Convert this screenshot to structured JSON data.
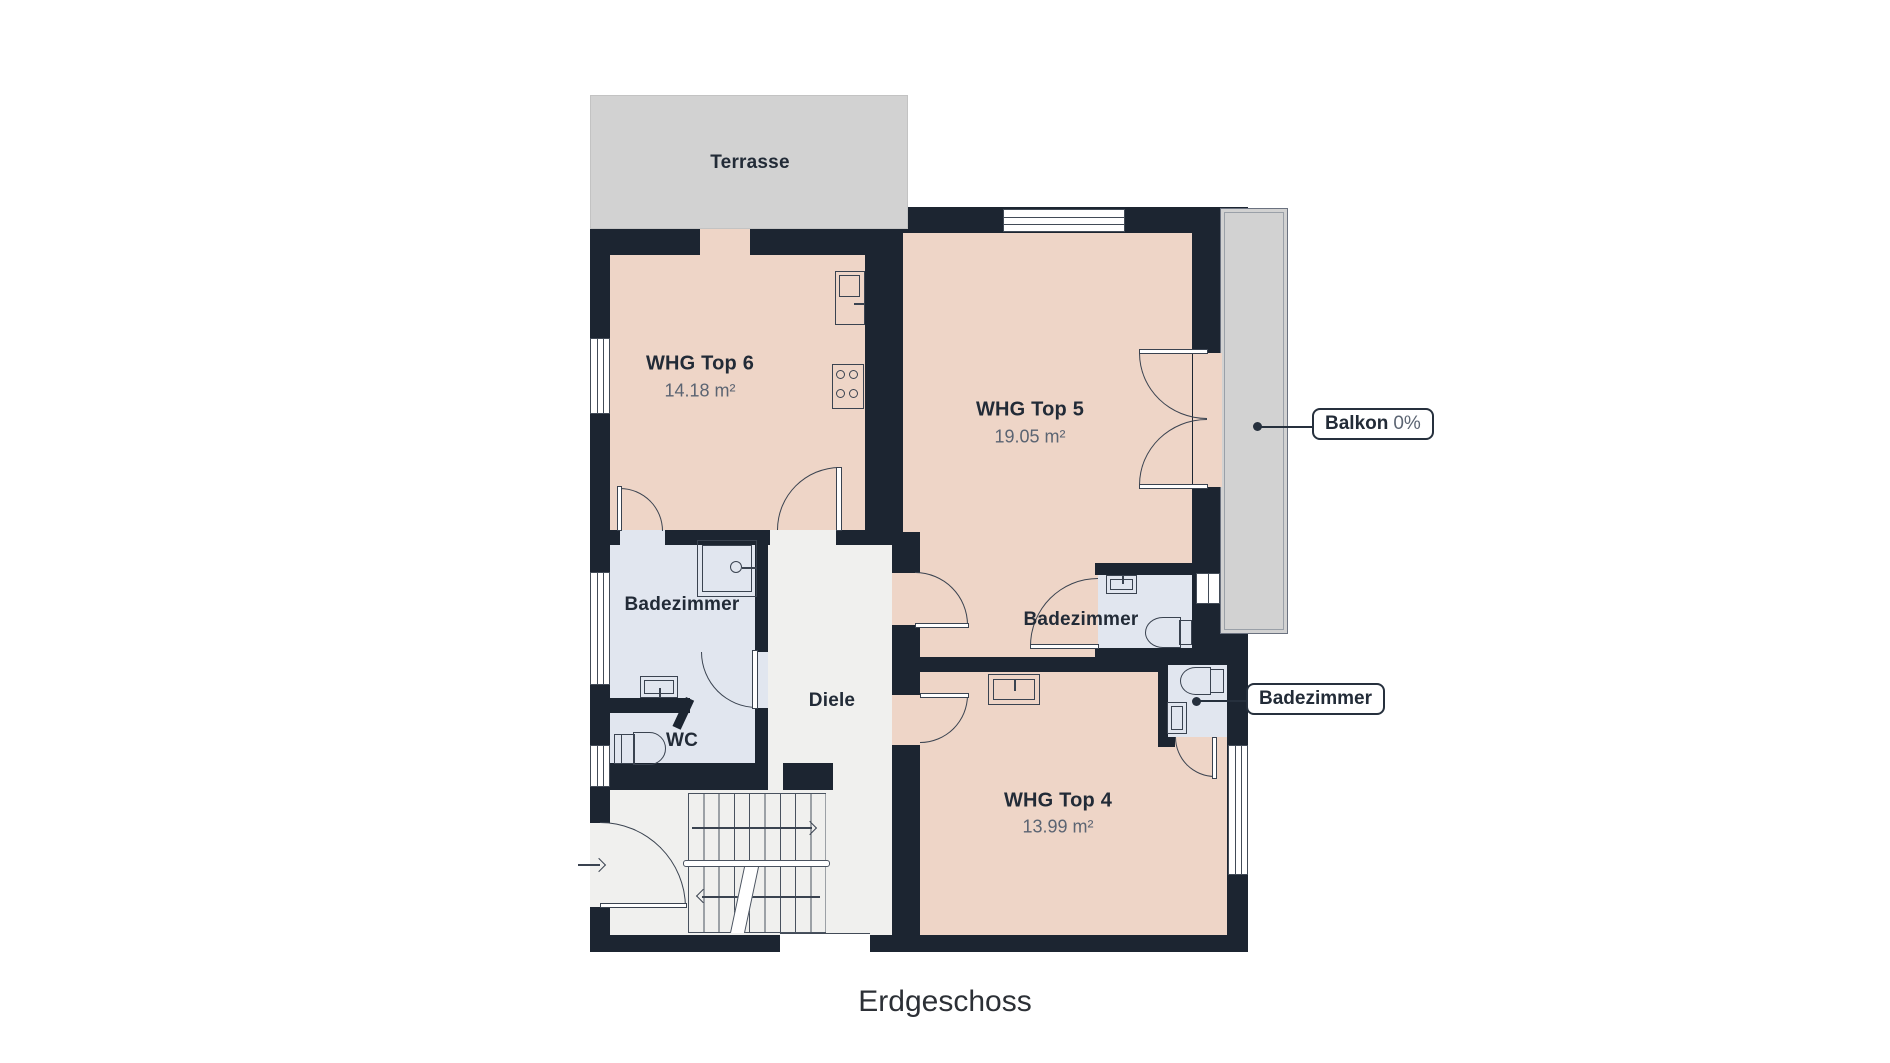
{
  "plan": {
    "caption": "Erdgeschoss",
    "terrace": {
      "label": "Terrasse"
    },
    "rooms": {
      "whg6": {
        "label": "WHG Top 6",
        "area": "14.18 m²"
      },
      "whg5": {
        "label": "WHG Top 5",
        "area": "19.05 m²"
      },
      "whg4": {
        "label": "WHG Top 4",
        "area": "13.99 m²"
      },
      "bad_left": {
        "label": "Badezimmer"
      },
      "bad_mid": {
        "label": "Badezimmer"
      },
      "wc": {
        "label": "WC"
      },
      "diele": {
        "label": "Diele"
      }
    },
    "callouts": {
      "balkon": {
        "label": "Balkon",
        "value": "0%"
      },
      "bad_right": {
        "label": "Badezimmer"
      }
    },
    "colors": {
      "wall": "#1c2531",
      "apartment_fill": "#eed5c7",
      "bathroom_fill": "#e1e6ef",
      "hallway_fill": "#f0f0ee",
      "outdoor_fill": "#d2d2d2",
      "callout_border": "#26303d"
    }
  }
}
